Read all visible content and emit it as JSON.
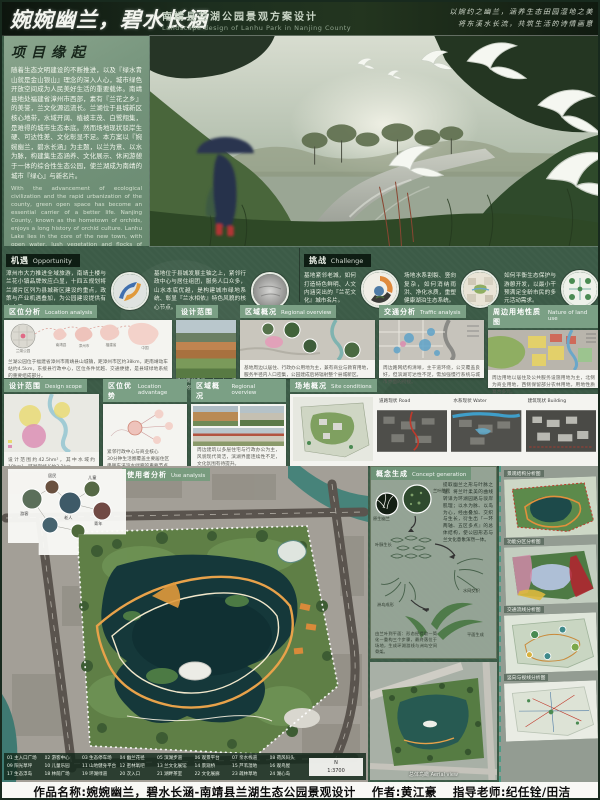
{
  "header": {
    "title_cn": "婉婉幽兰，碧水长涵",
    "subtitle_cn": "南靖县兰湖公园景观方案设计",
    "subtitle_en": "Landscape design of Lanhu Park in Nanjing County",
    "motto1": "以婉约之幽兰，涵养生态田园湿地之美",
    "motto2": "将东溪水长流，共筑生活的诗情画意"
  },
  "origin": {
    "title": "项目缘起",
    "para_cn": "随着生态文明建设的不断推进，以及『绿水青山就是金山银山』理念的深入人心，城市绿色开放空间成为人民美好生活的重要载体。南靖县地处福建省漳州市西部，素有『兰花之乡』的美誉，兰文化源远流长。兰湖位于县城新区核心地带，水域开阔、植被丰茂、白鹭翔集，是难得的城市生态本底。然而场地现状驳岸生硬、可达性差、文化彰显不足。本方案以『婉婉幽兰，碧水长涵』为主题，以兰为意、以水为脉，构建集生态涵养、文化展示、休闲游憩于一体的综合性生态公园，使兰湖成为南靖的城市『绿心』与新名片。",
    "para_en": "With the advancement of ecological civilization and the rapid urbanization of the county, green open space has become an essential carrier of a better life. Nanjing County, known as the hometown of orchids, enjoys a long history of orchid culture. Lanhu Lake lies in the core of the new town, with open water, lush vegetation and flocks of egrets. Themed 'Graceful Orchid, Long-flowing Clear Water', the design takes the orchid as the image and water as the vein, building a comprehensive ecological park integrating conservation, cultural display and recreation, making Lanhu Park a new green heart and 'business card' of Nanjing."
  },
  "opportunity": {
    "cn": "机遇",
    "en": "Opportunity",
    "item1": "漳州市大力推进全域旅游，南靖土楼与兰花小镇品牌效应凸显，十四五规划将兰湖片区列为县城新区建设的重点，政策与产业机遇叠加，为公园建设提供有力支撑。",
    "item2": "基地位于县城发展主轴之上，紧邻行政中心与居住组团，服务人口众多，山水本底优越，是构建城市绿地系统、彰显『兰水相依』特色风貌的核心节点。"
  },
  "challenge": {
    "cn": "挑战",
    "en": "Challenge",
    "item1": "基地紧邻老城，如何打造特色鲜明、人文内涵突出的『兰花文化』城市名片。",
    "item2": "场地水系割裂、竖向复杂，如何消纳雨洪、净化水质，重塑健康湖泊生态系统。",
    "item3": "如何平衡生态保护与游憩开发，以最小干预满足全龄市民的多元活动需求。"
  },
  "row1": {
    "location": {
      "cn": "区位分析",
      "en": "Location analysis",
      "nodes": [
        "兰湖公园",
        "南靖县",
        "漳州市",
        "福建省",
        "中国"
      ],
      "caption": "兰湖公园位于福建省漳州市南靖县山城镇，距漳州市区约38km，距南靖动车站约4.5km，东接县行政中心，区位条件优越、交通便捷，是县域绿地系统的重要组成部分。"
    },
    "scope": {
      "cn": "设计范围",
      "en": "Design scope",
      "caption": "场地现状鸟瞰：山、水、城交融的整体格局"
    },
    "regional": {
      "cn": "区域概况",
      "en": "Regional overview",
      "caption": "基地周边以居住、行政办公用地为主，兼有商业与教育用地，服务半径内人口密集，公园建成后将辐射整个县城新区。"
    },
    "traffic": {
      "cn": "交通分析",
      "en": "Traffic analysis",
      "caption": "周边路网结构清晰，主干道环绕，公交覆盖良好，但滨湖可达性不足，需加强慢行系统与城市界面的衔接。"
    },
    "landuse": {
      "cn": "周边用地性质图",
      "en": "Nature of land use",
      "caption": "周边用地以居住及公共服务设施用地为主，北侧为商业用地，西侧保留部分农林用地，用地性质复合多元。"
    }
  },
  "row2": {
    "scope2": {
      "cn": "设计范围",
      "en": "Design scope",
      "caption": "设计范围约42.5hm²，其中水域约18hm²，环湖岸线长约3.2km。"
    },
    "advantage": {
      "cn": "区位优势",
      "en": "Location advantage",
      "line1": "紧邻行政中心与商业核心",
      "line2": "30分钟生活圈覆盖主要居住区",
      "line3": "串联东溪滨水绿廊的重要节点"
    },
    "regional2": {
      "cn": "区域概况",
      "en": "Regional overview",
      "caption": "周边建筑以多层住宅与行政办公为主，风貌现代简洁，滨湖界面连续性不足，文化氛围有待提升。"
    },
    "site": {
      "cn": "场地概况",
      "en": "Site conditions",
      "map1": "道路现状 Road",
      "map2": "水系现状 Water",
      "map3": "建筑现状 Building"
    }
  },
  "master": {
    "label_cn": "使用者分析",
    "label_en": "Use analysis",
    "users": [
      "游客",
      "居民",
      "老人",
      "儿童",
      "青年"
    ],
    "scale": "1:3700",
    "north": "N"
  },
  "legend": {
    "items": [
      "01 主入口广场",
      "02 游客中心",
      "03 生态停车场",
      "04 幽兰花径",
      "05 滨湖步道",
      "06 观景平台",
      "07 亲水栈道",
      "08 荷风码头",
      "09 阳光草坪",
      "10 儿童乐园",
      "11 山地健身平台",
      "12 密林氧吧",
      "13 兰文化展馆",
      "14 景观桥",
      "15 芦苇湿地",
      "16 观鸟屋",
      "17 生态浮岛",
      "18 林荫广场",
      "19 环湖绿道",
      "20 次入口",
      "21 湖畔茶室",
      "22 文化展廊",
      "23 疏林草地",
      "24 湖心岛"
    ]
  },
  "concept": {
    "cn": "概念生成",
    "en": "Concept generation",
    "caption": "提取幽兰之形与叶脉之理，将兰叶柔美的曲线转译为环湖园路与驳岸肌理；以水为脉、以岛为心，经由叠加、交织与生长，衍生出『一环两轴、五区多点』的总体结构，使公园形态与兰文化意象浑然一体。",
    "note": "由兰叶到平面：形态经提取—简化—重构三个步骤，最终落位于场地，生成环湖游线与洲岛空间骨架。",
    "steps": [
      "原生幽兰",
      "兰叶肌理",
      "叶脉生长",
      "水网交织",
      "洲岛成形",
      "平面生成"
    ]
  },
  "render": {
    "caption_cn": "总体鸟瞰",
    "caption_en": "Aerial view"
  },
  "plans": {
    "p1": "景观结构分析图",
    "p2": "功能分区分析图",
    "p3": "交通流线分析图",
    "p4": "竖向与视线分析图"
  },
  "footer": {
    "work": "作品名称:婉婉幽兰，碧水长涵-南靖县兰湖生态公园景观设计",
    "author": "作者:黄江豪",
    "advisor": "指导老师:纪任铨/田洁"
  }
}
